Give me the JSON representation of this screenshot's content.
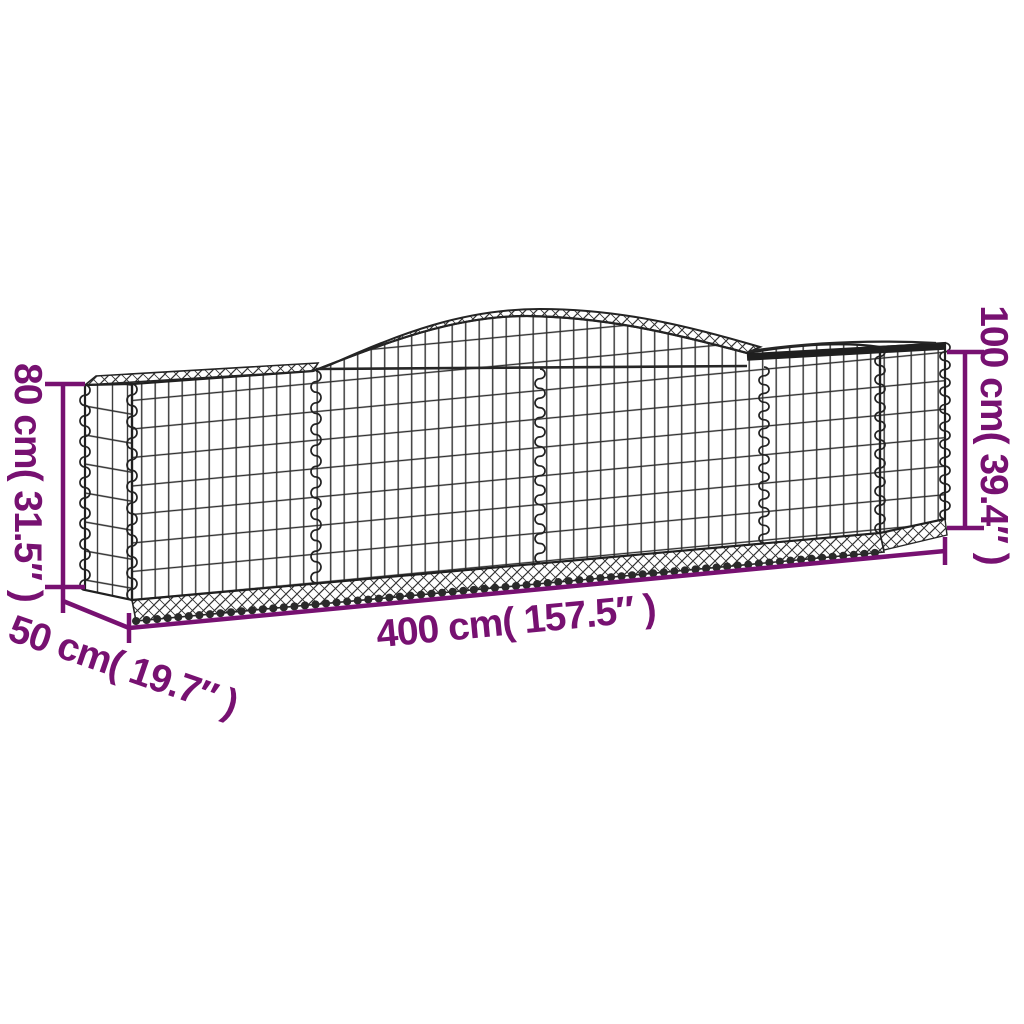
{
  "title": "Arched gabion basket dimension diagram",
  "product": "galvanised-iron-arched-gabion-basket",
  "dimensions": {
    "height_left": {
      "label": "80 cm( 31.5″ )",
      "value_cm": 80,
      "value_in": 31.5
    },
    "height_right": {
      "label": "100 cm( 39.4″ )",
      "value_cm": 100,
      "value_in": 39.4
    },
    "length": {
      "label": "400 cm( 157.5″ )",
      "value_cm": 400,
      "value_in": 157.5
    },
    "depth": {
      "label": "50 cm( 19.7″ )",
      "value_cm": 50,
      "value_in": 19.7
    }
  },
  "colors": {
    "dimension_annotation": "#771171",
    "wire": "#2e2e2e",
    "frame": "#1d1d1d",
    "background": "#ffffff"
  }
}
